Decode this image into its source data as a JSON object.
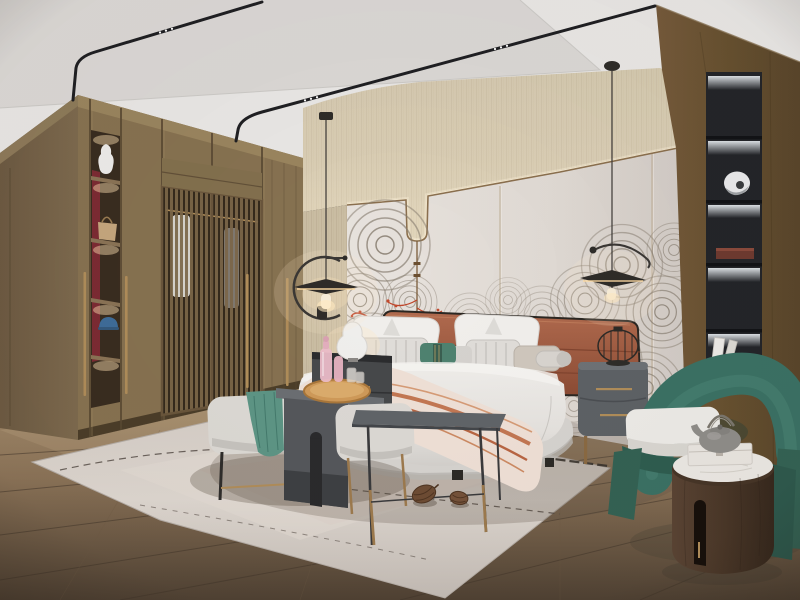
{
  "meta": {
    "scene": "modern-bedroom-interior-render",
    "visible_text": "none"
  },
  "palette": {
    "ceiling": "#e9e7e5",
    "ceiling_recess": "#dbd8d5",
    "track": "#1f1f22",
    "wallpaper": "#d9cdb4",
    "wallpaper_line": "#c6b99e",
    "cove_glow": "#fff4dc",
    "panel_light": "#e7e2dd",
    "panel_dark": "#d5cec8",
    "trim": "#8a6f4e",
    "mural": "#857b6e",
    "coral": "#bf4529",
    "wood_front": "#8d7855",
    "wood_side": "#75624a",
    "wood_dark": "#5a4933",
    "lattice": "#7d684a",
    "lattice_back": "#352a1d",
    "niche_red": "#7c2b34",
    "shelf_wood": "#8a7456",
    "brass": "#b08d5a",
    "pillar": "#6b5334",
    "pillar_dark": "#523f24",
    "niche_black": "#232529",
    "niche_divider": "#121316",
    "floor_light": "#a8906f",
    "floor_dark": "#574635",
    "floor_seam": "#42362a",
    "rug_light": "#ded7d0",
    "rug_dark": "#c7bfb8",
    "rug_line": "#4e453e",
    "duvet": "#e9e6e2",
    "bedding_shadow": "#c2bfbb",
    "sheet_white": "#f3f1ee",
    "headboard": "#a45e43",
    "headboard_seam": "#7f432e",
    "frame_black": "#2b2722",
    "pillow_stripe": "#bdbab6",
    "teal_pillow": "#4f8270",
    "teal_throw": "#5d9585",
    "chair_teal": "#3b7164",
    "chair_teal_dark": "#2f5d50",
    "cushion": "#edebe7",
    "bench": "#dcd9d4",
    "metal_dark": "#55575b",
    "metal_mid": "#6b6e72",
    "tray": "#cf9a59",
    "pink_glass": "#ecbdc9",
    "nightstand_left": "#47494b",
    "nightstand_right": "#5d6165",
    "marble": "#ebe8e3",
    "table_wood": "#4a3728",
    "teapot": "#8f8d89",
    "cone": "#6e4c34",
    "lamp_black": "#2f2c29",
    "lamp_glow": "#ffdca3",
    "throw_base": "#efe0d6",
    "throw_stripe": "#c0714c",
    "lamp_white": "#f0efed"
  },
  "objects": [
    "ceiling-track-lights",
    "pendant-lamps",
    "wardrobe-with-lattice-doors",
    "display-shelf-column",
    "arc-mural-headboard-wall",
    "cove-lit-wallpaper-band",
    "terracotta-headboard",
    "upholstered-bed",
    "striped-and-teal-pillows",
    "throw-blanket",
    "nightstand-left-with-lamp",
    "nightstand-right-with-lantern",
    "bench-with-teal-throw",
    "c-shaped-side-table",
    "wood-tray-with-pink-glassware",
    "stool",
    "metal-side-table",
    "area-rug",
    "pine-cones",
    "black-display-niche",
    "teal-armchair",
    "round-wood-side-table",
    "teapot",
    "storage-box",
    "wood-plank-floor",
    "wood-pillar-wall"
  ]
}
